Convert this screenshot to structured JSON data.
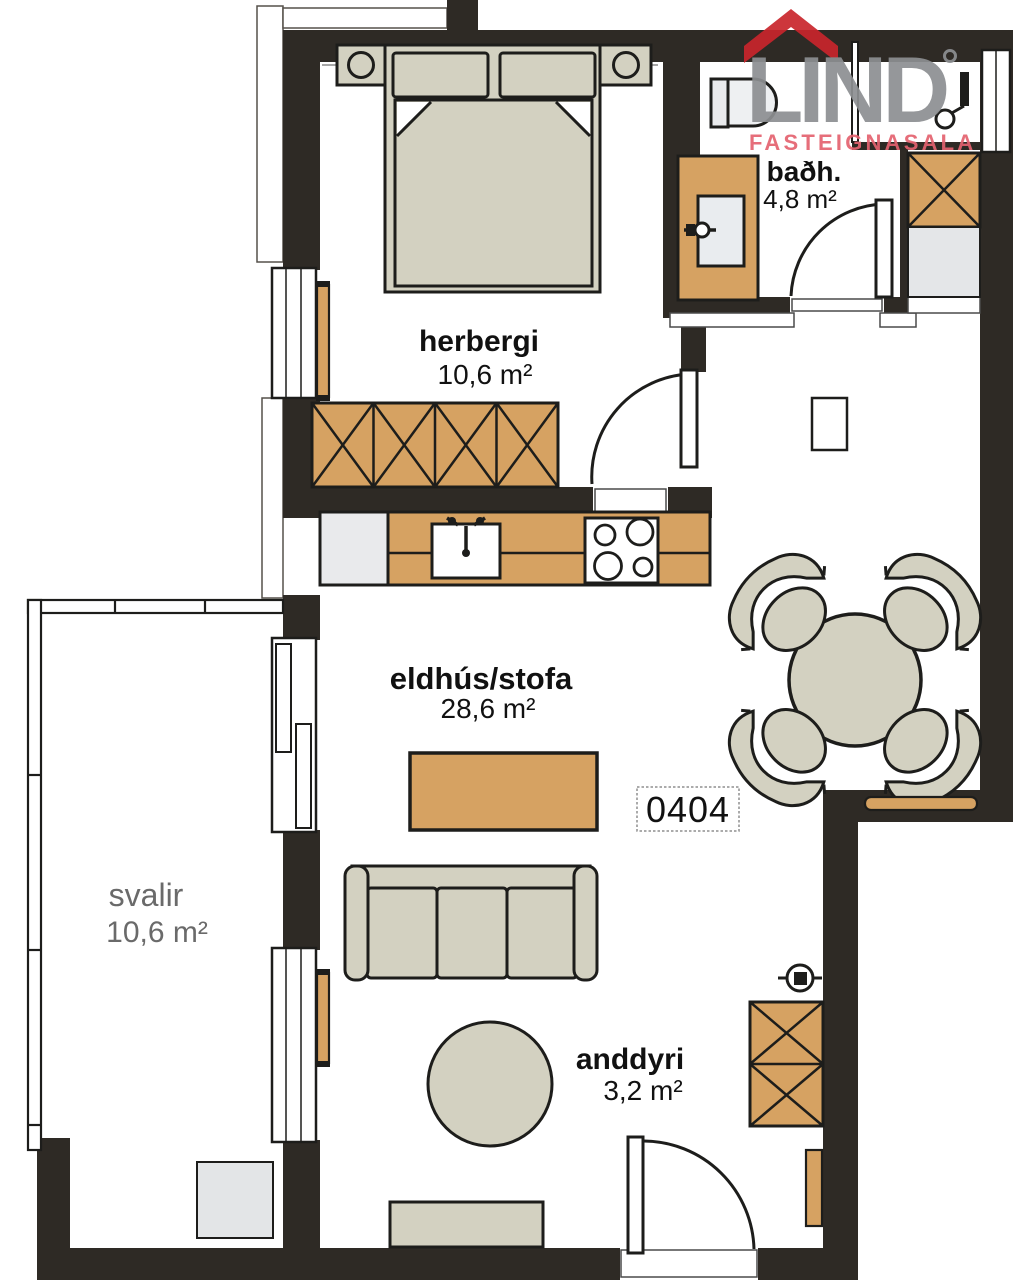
{
  "logo": {
    "brand": "LIND",
    "tagline": "FASTEIGNASALA",
    "colors": {
      "brand_gray": "#8d8f92",
      "roof_red": "#c9252c",
      "tagline_red": "#e4626f"
    }
  },
  "unit_label": "0404",
  "rooms": {
    "herbergi": {
      "label": "herbergi",
      "area": "10,6 m²"
    },
    "badherbergi": {
      "label": "baðh.",
      "area": "4,8 m²"
    },
    "eldhus_stofa": {
      "label": "eldhús/stofa",
      "area": "28,6 m²"
    },
    "svalir": {
      "label": "svalir",
      "area": "10,6 m²"
    },
    "anddyri": {
      "label": "anddyri",
      "area": "3,2 m²"
    }
  },
  "palette": {
    "wall": "#2e2a25",
    "wood": "#d6a262",
    "furniture_beige": "#d3d1c1",
    "fixture_gray": "#e9eaec",
    "floor_white": "#ffffff",
    "outline": "#1d1d1b",
    "muted_text": "#6a6a6a"
  }
}
